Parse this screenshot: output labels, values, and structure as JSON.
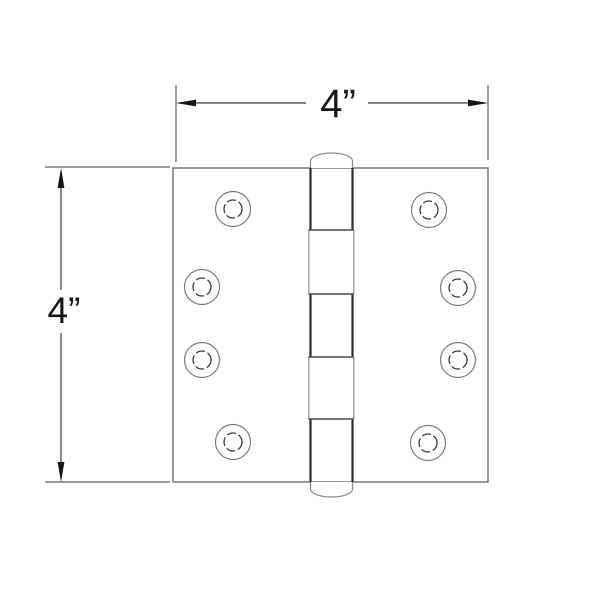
{
  "figure": {
    "type": "technical-line-drawing",
    "subject": "butt hinge, front view"
  },
  "dimensions": {
    "width": {
      "label": "4”"
    },
    "height": {
      "label": "4”"
    }
  },
  "hinge": {
    "screw_hole_count": 8,
    "knuckle_segment_count": 5
  },
  "colors": {
    "background": "#ffffff",
    "outline": "#6f6f6f",
    "dimension_line": "#7a7a7a",
    "arrow_and_text": "#161616",
    "barrel_dark": "#2d2d2d",
    "barrel_light": "#999999"
  }
}
